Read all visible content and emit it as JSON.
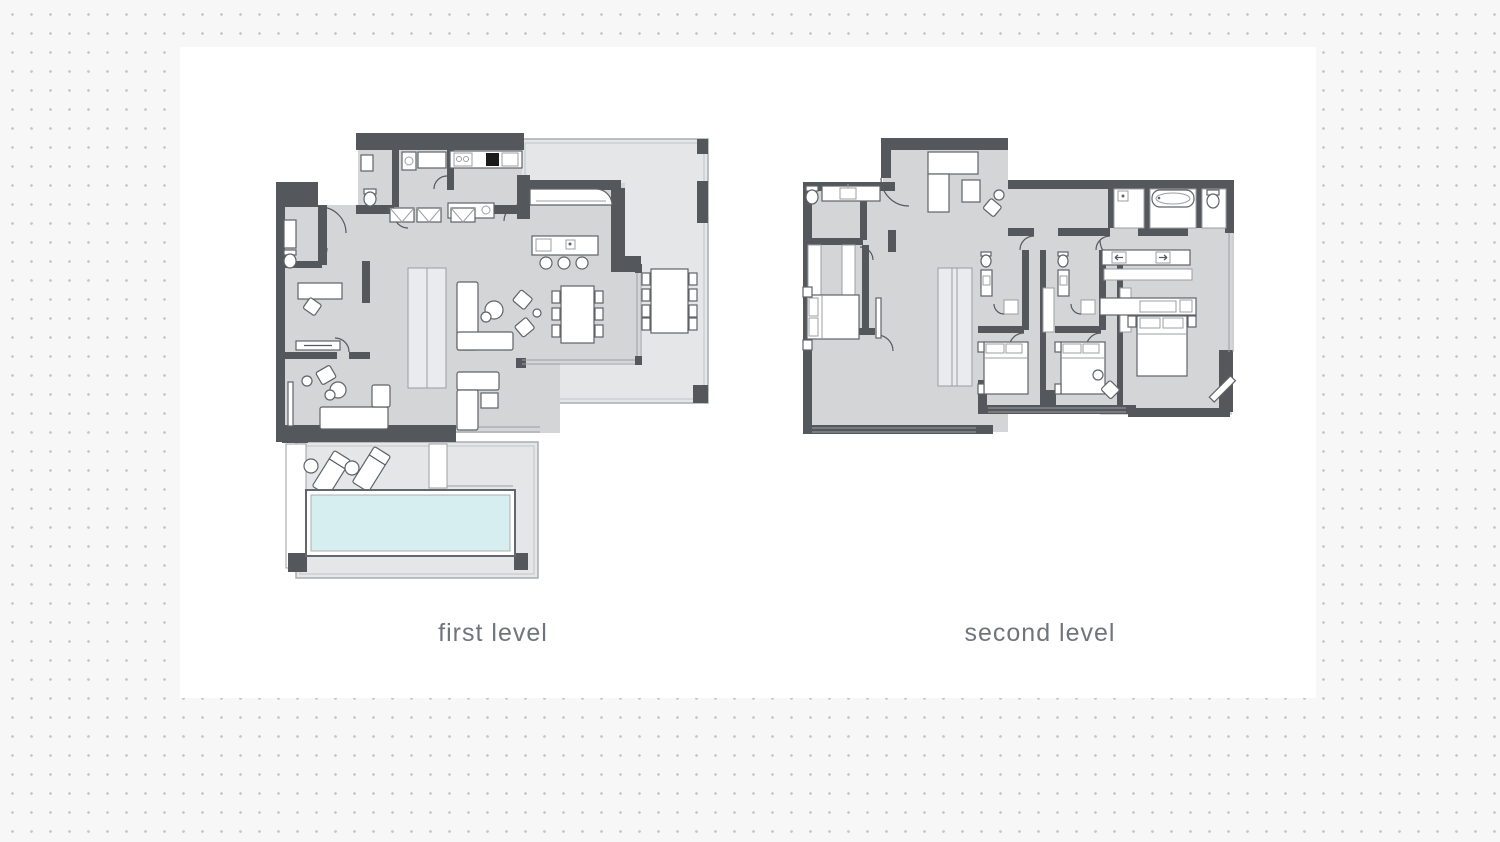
{
  "canvas": {
    "width": 1500,
    "height": 842
  },
  "background": {
    "page_bg": "#f7f7f7",
    "panel_bg": "#ffffff",
    "dot_color": "#c8c9ca"
  },
  "palette": {
    "wall": "#54585d",
    "floor": "#d3d5d7",
    "terrace": "#e4e6e8",
    "stairs": "#eaebec",
    "fixture_stroke": "#5f6367",
    "thin_line": "#9b9fa2",
    "water": "#d7eef0",
    "water_rim": "#63676b",
    "cooktop": "#1a1a1a",
    "label": "#6f757b"
  },
  "plans": [
    {
      "label": "first level",
      "features": [
        "entry",
        "guest-wc",
        "laundry",
        "kitchen",
        "kitchen-island",
        "pantry",
        "study",
        "family-room",
        "living-room",
        "dining-area",
        "stairs",
        "terrace",
        "outdoor-dining-table",
        "pool-deck",
        "sun-loungers",
        "swimming-pool"
      ]
    },
    {
      "label": "second level",
      "features": [
        "bathroom",
        "walk-in-closet",
        "lounge",
        "corridor",
        "shower-room",
        "bathtub-room",
        "wc",
        "bedroom",
        "bedroom",
        "bedroom",
        "en-suite-bathroom",
        "en-suite-bathroom",
        "master-bedroom",
        "master-vanity",
        "wardrobes",
        "stairs"
      ]
    }
  ]
}
